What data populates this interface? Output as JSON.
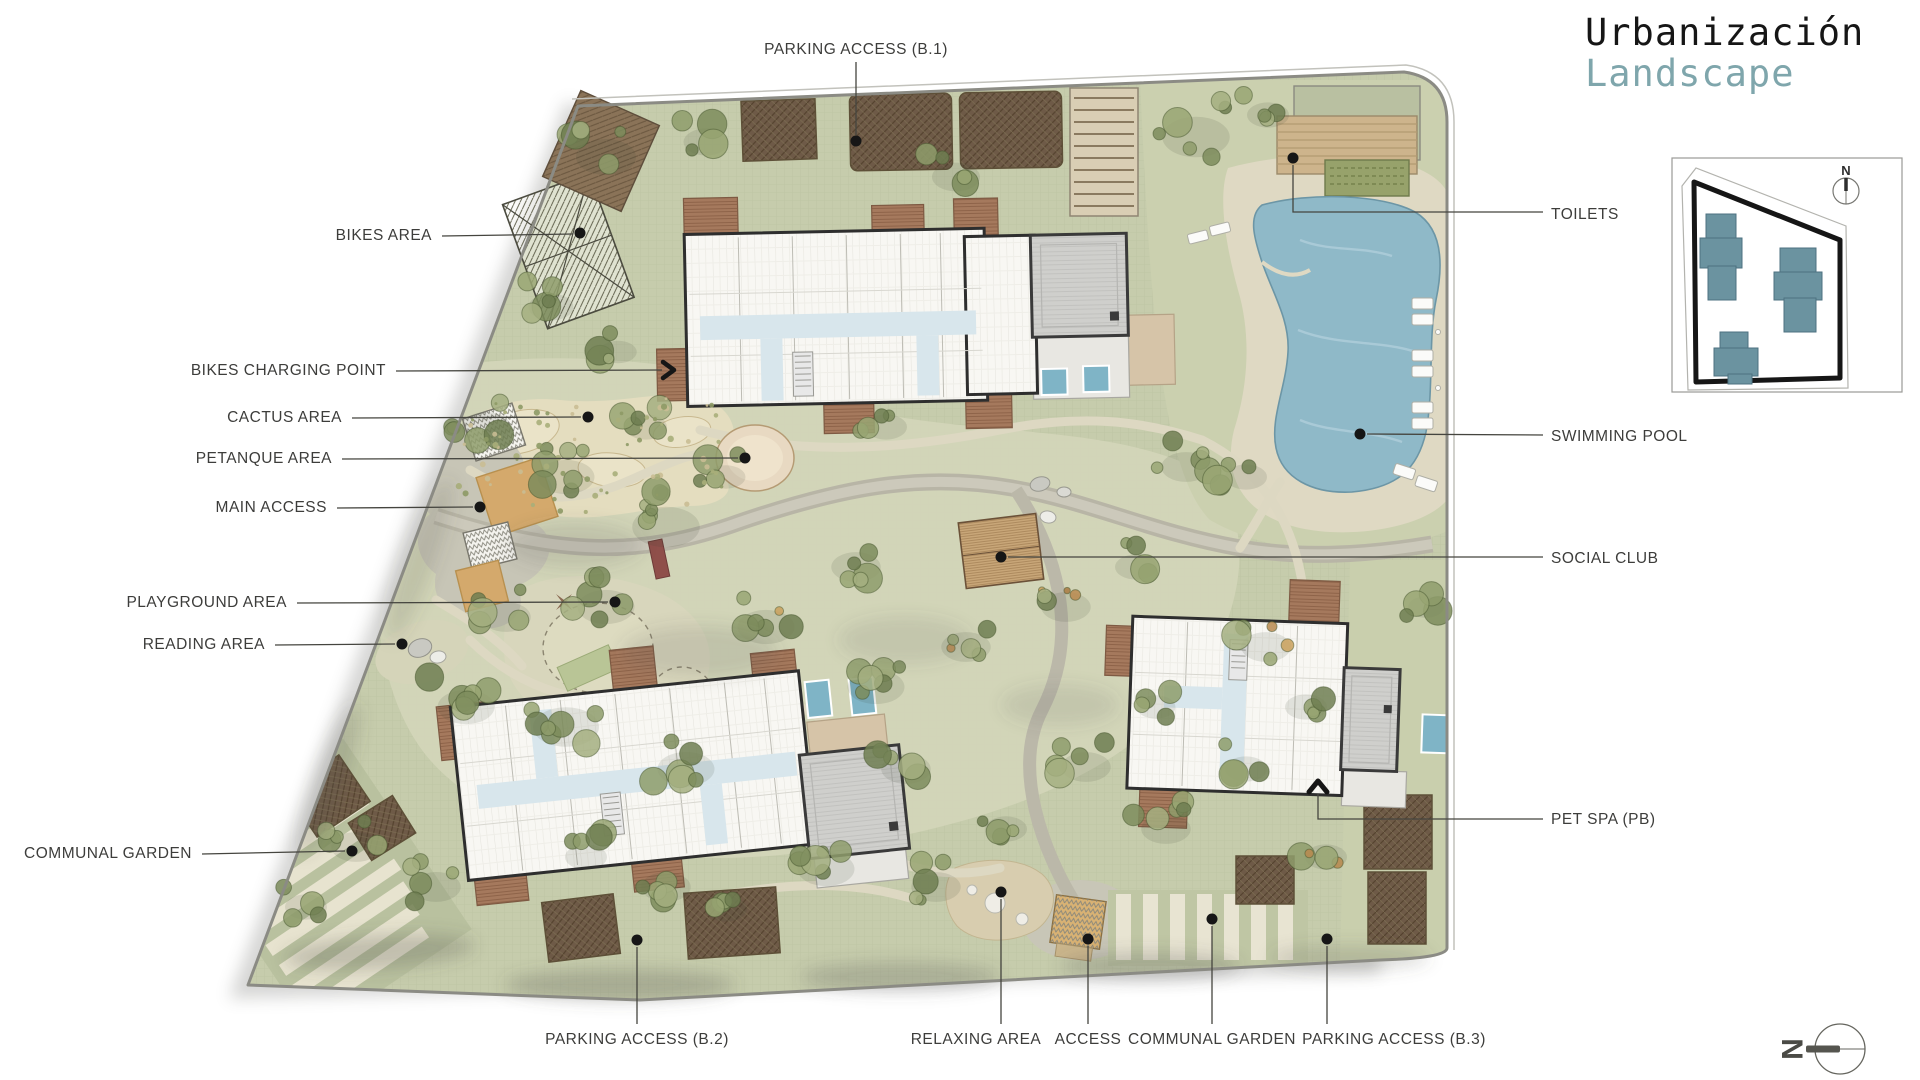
{
  "title": {
    "line1": "Urbanización",
    "line2": "Landscape"
  },
  "compass": {
    "north_letter": "N"
  },
  "colors": {
    "accent_teal": "#7FA6AC",
    "label_text": "#3D3D3B",
    "leader_line": "#45453F",
    "site_green": "#C6CCAC",
    "garden_green": "#D3D5B8",
    "pool_blue": "#8FB9C8",
    "plunge_pool_blue": "#7FB4C6",
    "deck_brown": "#A5795D",
    "roof_gray": "#CFCFCC",
    "plaza_tan": "#D4A96C",
    "hedge_brown": "#6E5A47",
    "inset_building_teal": "#6B93A0"
  },
  "labels": [
    {
      "id": "parking-access-b1",
      "text": "PARKING ACCESS (B.1)",
      "tx": 856,
      "ty": 50,
      "anchor": "middle",
      "leader": [
        [
          856,
          62
        ],
        [
          856,
          135
        ]
      ],
      "marker": {
        "type": "dot",
        "x": 856,
        "y": 141
      }
    },
    {
      "id": "bikes-area",
      "text": "BIKES AREA",
      "tx": 432,
      "ty": 236,
      "anchor": "end",
      "leader": [
        [
          442,
          236
        ],
        [
          573,
          234
        ]
      ],
      "marker": {
        "type": "dot",
        "x": 580,
        "y": 233
      }
    },
    {
      "id": "bikes-charging-point",
      "text": "BIKES CHARGING POINT",
      "tx": 386,
      "ty": 371,
      "anchor": "end",
      "leader": [
        [
          396,
          371
        ],
        [
          662,
          370
        ]
      ],
      "marker": {
        "type": "arrow-right",
        "x": 672,
        "y": 370
      }
    },
    {
      "id": "cactus-area",
      "text": "CACTUS AREA",
      "tx": 342,
      "ty": 418,
      "anchor": "end",
      "leader": [
        [
          352,
          418
        ],
        [
          581,
          417
        ]
      ],
      "marker": {
        "type": "dot",
        "x": 588,
        "y": 417
      }
    },
    {
      "id": "petanque-area",
      "text": "PETANQUE AREA",
      "tx": 332,
      "ty": 459,
      "anchor": "end",
      "leader": [
        [
          342,
          459
        ],
        [
          738,
          458
        ]
      ],
      "marker": {
        "type": "dot",
        "x": 745,
        "y": 458
      }
    },
    {
      "id": "main-access",
      "text": "MAIN ACCESS",
      "tx": 327,
      "ty": 508,
      "anchor": "end",
      "leader": [
        [
          337,
          508
        ],
        [
          473,
          507
        ]
      ],
      "marker": {
        "type": "dot",
        "x": 480,
        "y": 507
      }
    },
    {
      "id": "playground-area",
      "text": "PLAYGROUND AREA",
      "tx": 287,
      "ty": 603,
      "anchor": "end",
      "leader": [
        [
          297,
          603
        ],
        [
          608,
          602
        ]
      ],
      "marker": {
        "type": "dot",
        "x": 615,
        "y": 602
      }
    },
    {
      "id": "reading-area",
      "text": "READING AREA",
      "tx": 265,
      "ty": 645,
      "anchor": "end",
      "leader": [
        [
          275,
          645
        ],
        [
          395,
          644
        ]
      ],
      "marker": {
        "type": "dot",
        "x": 402,
        "y": 644
      }
    },
    {
      "id": "communal-garden-left",
      "text": "COMMUNAL GARDEN",
      "tx": 192,
      "ty": 854,
      "anchor": "end",
      "leader": [
        [
          202,
          854
        ],
        [
          345,
          851
        ]
      ],
      "marker": {
        "type": "dot",
        "x": 352,
        "y": 851
      }
    },
    {
      "id": "parking-access-b2",
      "text": "PARKING ACCESS (B.2)",
      "tx": 637,
      "ty": 1040,
      "anchor": "middle",
      "leader": [
        [
          637,
          1024
        ],
        [
          637,
          947
        ]
      ],
      "marker": {
        "type": "dot",
        "x": 637,
        "y": 940
      }
    },
    {
      "id": "relaxing-area",
      "text": "RELAXING AREA",
      "tx": 976,
      "ty": 1040,
      "anchor": "middle",
      "leader": [
        [
          1001,
          1024
        ],
        [
          1001,
          899
        ]
      ],
      "marker": {
        "type": "dot",
        "x": 1001,
        "y": 892
      }
    },
    {
      "id": "access",
      "text": "ACCESS",
      "tx": 1088,
      "ty": 1040,
      "anchor": "middle",
      "leader": [
        [
          1088,
          1024
        ],
        [
          1088,
          946
        ]
      ],
      "marker": {
        "type": "dot",
        "x": 1088,
        "y": 939
      }
    },
    {
      "id": "communal-garden-bottom",
      "text": "COMMUNAL GARDEN",
      "tx": 1212,
      "ty": 1040,
      "anchor": "middle",
      "leader": [
        [
          1212,
          1024
        ],
        [
          1212,
          926
        ]
      ],
      "marker": {
        "type": "dot",
        "x": 1212,
        "y": 919
      }
    },
    {
      "id": "parking-access-b3",
      "text": "PARKING ACCESS (B.3)",
      "tx": 1394,
      "ty": 1040,
      "anchor": "middle",
      "leader": [
        [
          1327,
          1024
        ],
        [
          1327,
          946
        ]
      ],
      "marker": {
        "type": "dot",
        "x": 1327,
        "y": 939
      }
    },
    {
      "id": "toilets",
      "text": "TOILETS",
      "tx": 1551,
      "ty": 215,
      "anchor": "start",
      "leader": [
        [
          1543,
          212
        ],
        [
          1293,
          212
        ],
        [
          1293,
          165
        ]
      ],
      "marker": {
        "type": "dot",
        "x": 1293,
        "y": 158
      }
    },
    {
      "id": "swimming-pool",
      "text": "SWIMMING POOL",
      "tx": 1551,
      "ty": 437,
      "anchor": "start",
      "leader": [
        [
          1543,
          435
        ],
        [
          1367,
          434
        ]
      ],
      "marker": {
        "type": "dot",
        "x": 1360,
        "y": 434
      }
    },
    {
      "id": "social-club",
      "text": "SOCIAL CLUB",
      "tx": 1551,
      "ty": 559,
      "anchor": "start",
      "leader": [
        [
          1543,
          557
        ],
        [
          1008,
          557
        ]
      ],
      "marker": {
        "type": "dot",
        "x": 1001,
        "y": 557
      }
    },
    {
      "id": "pet-spa-pb",
      "text": "PET SPA (PB)",
      "tx": 1551,
      "ty": 820,
      "anchor": "start",
      "leader": [
        [
          1543,
          819
        ],
        [
          1318,
          819
        ],
        [
          1318,
          794
        ]
      ],
      "marker": {
        "type": "arrow-up",
        "x": 1318,
        "y": 785
      }
    }
  ]
}
